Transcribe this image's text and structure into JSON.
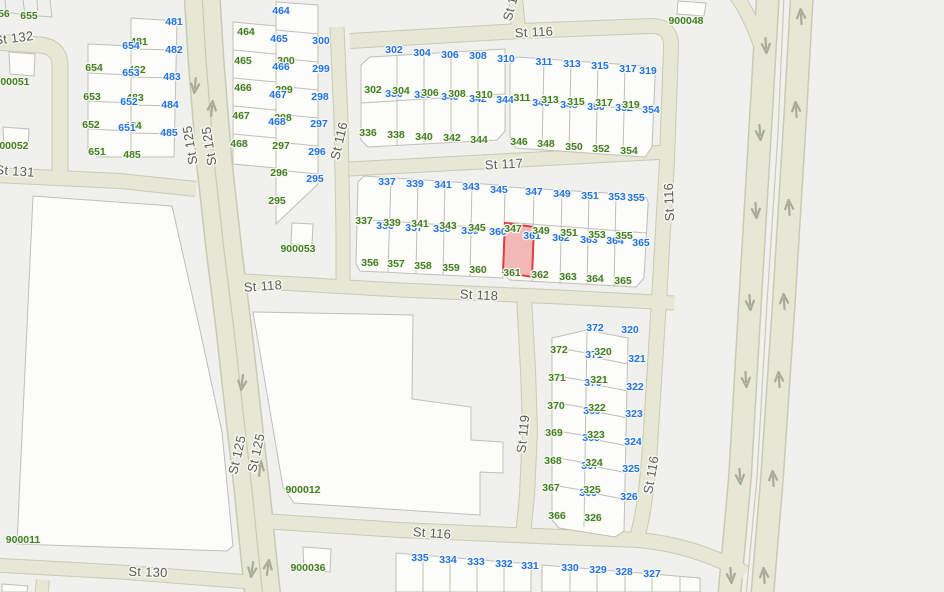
{
  "map": {
    "colors": {
      "background": "#f0f0ed",
      "block_fill": "#fcfcf9",
      "road_fill": "#e6e7d4",
      "road_casing": "#c8cbb3",
      "parcel_line": "#c1beb8",
      "label_green": "#448022",
      "label_blue": "#2275e2",
      "street_label": "#5a5f52",
      "halo": "#f6f6f2",
      "arrow": "#a8ab9b",
      "selected_fill": "#efa0a0",
      "selected_stroke": "#e23d3d"
    },
    "selected_parcel": {
      "number": "361"
    },
    "street_labels": [
      {
        "t": "St 132",
        "x": 14,
        "y": 39,
        "r": -7
      },
      {
        "t": "St 131",
        "x": 15,
        "y": 172,
        "r": 4
      },
      {
        "t": "St 125",
        "x": 191,
        "y": 145,
        "r": -99
      },
      {
        "t": "St 125",
        "x": 210,
        "y": 146,
        "r": -99
      },
      {
        "t": "St 125",
        "x": 238,
        "y": 455,
        "r": -77
      },
      {
        "t": "St 125",
        "x": 257,
        "y": 453,
        "r": -77
      },
      {
        "t": "St 116",
        "x": 534,
        "y": 33,
        "r": -3
      },
      {
        "t": "St 116",
        "x": 340,
        "y": 141,
        "r": -77
      },
      {
        "t": "St 116",
        "x": 513,
        "y": 2,
        "r": -75
      },
      {
        "t": "St 117",
        "x": 504,
        "y": 165,
        "r": -3
      },
      {
        "t": "St 118",
        "x": 263,
        "y": 287,
        "r": -4
      },
      {
        "t": "St 118",
        "x": 479,
        "y": 296,
        "r": 3
      },
      {
        "t": "St 119",
        "x": 524,
        "y": 434,
        "r": -84
      },
      {
        "t": "St 116",
        "x": 670,
        "y": 202,
        "r": -92
      },
      {
        "t": "St 116",
        "x": 652,
        "y": 475,
        "r": -80
      },
      {
        "t": "St 116",
        "x": 432,
        "y": 534,
        "r": 4
      },
      {
        "t": "St 130",
        "x": 148,
        "y": 573,
        "r": 2
      }
    ],
    "block_labels": [
      {
        "t": "900048",
        "x": 686,
        "y": 21
      },
      {
        "t": "900051",
        "x": 12,
        "y": 82
      },
      {
        "t": "900052",
        "x": 11,
        "y": 146
      },
      {
        "t": "900053",
        "x": 298,
        "y": 249
      },
      {
        "t": "900012",
        "x": 303,
        "y": 490
      },
      {
        "t": "900011",
        "x": 23,
        "y": 540
      },
      {
        "t": "900036",
        "x": 308,
        "y": 568
      }
    ],
    "parcel_labels": [
      [
        "656",
        "g",
        1,
        14
      ],
      [
        "655",
        "g",
        29,
        16
      ],
      [
        "481",
        "b",
        174,
        22
      ],
      [
        "481",
        "g",
        139,
        42
      ],
      [
        "654",
        "b",
        131,
        46
      ],
      [
        "482",
        "b",
        174,
        50
      ],
      [
        "654",
        "g",
        94,
        68
      ],
      [
        "482",
        "g",
        137,
        70
      ],
      [
        "653",
        "b",
        131,
        73
      ],
      [
        "483",
        "b",
        172,
        77
      ],
      [
        "653",
        "g",
        92,
        97
      ],
      [
        "483",
        "g",
        135,
        98
      ],
      [
        "652",
        "b",
        129,
        102
      ],
      [
        "484",
        "b",
        170,
        105
      ],
      [
        "652",
        "g",
        91,
        125
      ],
      [
        "484",
        "g",
        133,
        126
      ],
      [
        "651",
        "b",
        127,
        128
      ],
      [
        "485",
        "b",
        169,
        133
      ],
      [
        "651",
        "g",
        97,
        152
      ],
      [
        "485",
        "g",
        132,
        155
      ],
      [
        "464",
        "b",
        281,
        11
      ],
      [
        "464",
        "g",
        246,
        32
      ],
      [
        "465",
        "b",
        279,
        39
      ],
      [
        "300",
        "b",
        321,
        41
      ],
      [
        "465",
        "g",
        243,
        61
      ],
      [
        "300",
        "g",
        286,
        61
      ],
      [
        "466",
        "b",
        281,
        67
      ],
      [
        "299",
        "b",
        321,
        69
      ],
      [
        "466",
        "g",
        243,
        88
      ],
      [
        "299",
        "g",
        284,
        90
      ],
      [
        "467",
        "b",
        278,
        95
      ],
      [
        "298",
        "b",
        320,
        97
      ],
      [
        "467",
        "g",
        241,
        116
      ],
      [
        "298",
        "g",
        283,
        118
      ],
      [
        "468",
        "b",
        277,
        122
      ],
      [
        "297",
        "b",
        319,
        124
      ],
      [
        "468",
        "g",
        239,
        144
      ],
      [
        "297",
        "g",
        281,
        146
      ],
      [
        "296",
        "b",
        317,
        152
      ],
      [
        "296",
        "g",
        279,
        173
      ],
      [
        "295",
        "b",
        315,
        179
      ],
      [
        "295",
        "g",
        277,
        201
      ],
      [
        "302",
        "b",
        394,
        50
      ],
      [
        "304",
        "b",
        422,
        53
      ],
      [
        "306",
        "b",
        450,
        55
      ],
      [
        "308",
        "b",
        478,
        56
      ],
      [
        "310",
        "b",
        506,
        59
      ],
      [
        "302",
        "g",
        373,
        90
      ],
      [
        "336",
        "b",
        394,
        94
      ],
      [
        "304",
        "g",
        401,
        91
      ],
      [
        "338",
        "b",
        423,
        95
      ],
      [
        "306",
        "g",
        430,
        93
      ],
      [
        "340",
        "b",
        450,
        97
      ],
      [
        "308",
        "g",
        457,
        94
      ],
      [
        "342",
        "b",
        478,
        99
      ],
      [
        "310",
        "g",
        484,
        95
      ],
      [
        "344",
        "b",
        505,
        100
      ],
      [
        "336",
        "g",
        368,
        133
      ],
      [
        "338",
        "g",
        396,
        135
      ],
      [
        "340",
        "g",
        424,
        137
      ],
      [
        "342",
        "g",
        452,
        138
      ],
      [
        "344",
        "g",
        479,
        140
      ],
      [
        "311",
        "b",
        544,
        62
      ],
      [
        "313",
        "b",
        572,
        64
      ],
      [
        "315",
        "b",
        600,
        66
      ],
      [
        "317",
        "b",
        628,
        69
      ],
      [
        "319",
        "b",
        648,
        71
      ],
      [
        "311",
        "g",
        522,
        98
      ],
      [
        "346",
        "b",
        541,
        103
      ],
      [
        "313",
        "g",
        550,
        100
      ],
      [
        "348",
        "b",
        569,
        105
      ],
      [
        "315",
        "g",
        576,
        102
      ],
      [
        "350",
        "b",
        596,
        107
      ],
      [
        "317",
        "g",
        604,
        103
      ],
      [
        "352",
        "b",
        624,
        108
      ],
      [
        "319",
        "g",
        631,
        105
      ],
      [
        "354",
        "b",
        651,
        110
      ],
      [
        "346",
        "g",
        519,
        142
      ],
      [
        "348",
        "g",
        546,
        144
      ],
      [
        "350",
        "g",
        574,
        147
      ],
      [
        "352",
        "g",
        601,
        149
      ],
      [
        "354",
        "g",
        629,
        151
      ],
      [
        "337",
        "b",
        387,
        182
      ],
      [
        "339",
        "b",
        415,
        184
      ],
      [
        "341",
        "b",
        443,
        185
      ],
      [
        "343",
        "b",
        471,
        187
      ],
      [
        "345",
        "b",
        499,
        190
      ],
      [
        "337",
        "g",
        364,
        221
      ],
      [
        "356",
        "b",
        385,
        226
      ],
      [
        "339",
        "g",
        392,
        223
      ],
      [
        "357",
        "b",
        414,
        228
      ],
      [
        "341",
        "g",
        420,
        224
      ],
      [
        "358",
        "b",
        442,
        229
      ],
      [
        "343",
        "g",
        448,
        226
      ],
      [
        "359",
        "b",
        470,
        231
      ],
      [
        "345",
        "g",
        477,
        228
      ],
      [
        "360",
        "b",
        498,
        232
      ],
      [
        "356",
        "g",
        370,
        263
      ],
      [
        "357",
        "g",
        396,
        264
      ],
      [
        "358",
        "g",
        423,
        266
      ],
      [
        "359",
        "g",
        451,
        268
      ],
      [
        "360",
        "g",
        478,
        270
      ],
      [
        "347",
        "b",
        534,
        192
      ],
      [
        "349",
        "b",
        562,
        194
      ],
      [
        "351",
        "b",
        590,
        196
      ],
      [
        "353",
        "b",
        617,
        197
      ],
      [
        "355",
        "b",
        636,
        198
      ],
      [
        "347",
        "g",
        513,
        229
      ],
      [
        "361",
        "b",
        532,
        236
      ],
      [
        "349",
        "g",
        541,
        231
      ],
      [
        "362",
        "b",
        561,
        238
      ],
      [
        "351",
        "g",
        569,
        233
      ],
      [
        "363",
        "b",
        589,
        240
      ],
      [
        "353",
        "g",
        597,
        235
      ],
      [
        "364",
        "b",
        615,
        241
      ],
      [
        "355",
        "g",
        624,
        236
      ],
      [
        "365",
        "b",
        641,
        243
      ],
      [
        "361",
        "g",
        512,
        273
      ],
      [
        "362",
        "g",
        540,
        275
      ],
      [
        "363",
        "g",
        568,
        277
      ],
      [
        "364",
        "g",
        595,
        279
      ],
      [
        "365",
        "g",
        623,
        281
      ],
      [
        "372",
        "b",
        595,
        328
      ],
      [
        "320",
        "b",
        630,
        330
      ],
      [
        "372",
        "g",
        559,
        350
      ],
      [
        "371",
        "b",
        594,
        355
      ],
      [
        "320",
        "g",
        603,
        352
      ],
      [
        "321",
        "b",
        637,
        359
      ],
      [
        "371",
        "g",
        557,
        378
      ],
      [
        "370",
        "b",
        593,
        383
      ],
      [
        "321",
        "g",
        599,
        380
      ],
      [
        "322",
        "b",
        635,
        387
      ],
      [
        "370",
        "g",
        556,
        406
      ],
      [
        "369",
        "b",
        592,
        411
      ],
      [
        "322",
        "g",
        597,
        408
      ],
      [
        "323",
        "b",
        634,
        414
      ],
      [
        "369",
        "g",
        554,
        433
      ],
      [
        "368",
        "b",
        591,
        438
      ],
      [
        "323",
        "g",
        596,
        435
      ],
      [
        "324",
        "b",
        633,
        442
      ],
      [
        "368",
        "g",
        553,
        461
      ],
      [
        "367",
        "b",
        590,
        466
      ],
      [
        "324",
        "g",
        594,
        463
      ],
      [
        "325",
        "b",
        631,
        469
      ],
      [
        "367",
        "g",
        551,
        488
      ],
      [
        "366",
        "b",
        588,
        493
      ],
      [
        "325",
        "g",
        592,
        490
      ],
      [
        "326",
        "b",
        629,
        497
      ],
      [
        "366",
        "g",
        557,
        516
      ],
      [
        "326",
        "g",
        593,
        518
      ],
      [
        "335",
        "b",
        420,
        558
      ],
      [
        "334",
        "b",
        448,
        560
      ],
      [
        "333",
        "b",
        476,
        562
      ],
      [
        "332",
        "b",
        504,
        564
      ],
      [
        "331",
        "b",
        530,
        566
      ],
      [
        "330",
        "b",
        570,
        568
      ],
      [
        "329",
        "b",
        598,
        570
      ],
      [
        "328",
        "b",
        624,
        572
      ],
      [
        "327",
        "b",
        652,
        574
      ]
    ],
    "arrows": [
      [
        "dn",
        195,
        86,
        6
      ],
      [
        "up",
        212,
        108,
        6
      ],
      [
        "dn",
        242,
        383,
        7
      ],
      [
        "up",
        260,
        468,
        7
      ],
      [
        "dn",
        252,
        570,
        8
      ],
      [
        "up",
        268,
        567,
        8
      ],
      [
        "dn",
        766,
        46,
        -4
      ],
      [
        "up",
        801,
        16,
        -4
      ],
      [
        "dn",
        760,
        133,
        -4
      ],
      [
        "up",
        796,
        109,
        -4
      ],
      [
        "dn",
        756,
        211,
        -4
      ],
      [
        "up",
        789,
        207,
        -4
      ],
      [
        "dn",
        750,
        303,
        -4
      ],
      [
        "up",
        784,
        301,
        -4
      ],
      [
        "dn",
        746,
        380,
        -4
      ],
      [
        "up",
        779,
        379,
        -4
      ],
      [
        "dn",
        740,
        477,
        -4
      ],
      [
        "up",
        773,
        478,
        -4
      ],
      [
        "dn",
        731,
        576,
        -4
      ],
      [
        "up",
        764,
        575,
        -4
      ]
    ]
  }
}
